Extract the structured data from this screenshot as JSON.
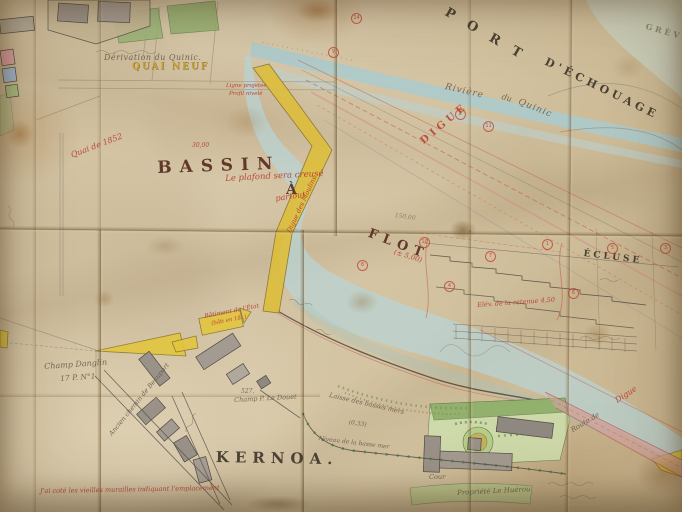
{
  "colors": {
    "paper": "#d3c3a2",
    "paper_shadow": "#b89f78",
    "water_blue": "#b7d6da",
    "water_pale": "#c9dcd4",
    "quay_yellow": "#ddbe3e",
    "garden_green": "#9ab578",
    "building_gray": "#9a9288",
    "road_pink": "#d2a2a0",
    "ink_dark": "#3f382f",
    "ink_maroon": "#5c2f24",
    "ink_red": "#b6372a",
    "pencil": "#8d8273"
  },
  "labels": [
    {
      "id": "port",
      "text": "PORT",
      "x": 449,
      "y": 6,
      "rot": 30,
      "fs": 13,
      "ls": 15,
      "cls": "ink-caps"
    },
    {
      "id": "d-echouage",
      "text": "D'ÉCHOUAGE",
      "x": 548,
      "y": 56,
      "rot": 26,
      "fs": 11,
      "ls": 4,
      "cls": "ink-caps"
    },
    {
      "id": "greve",
      "text": "GRÈVE",
      "x": 647,
      "y": 22,
      "rot": 16,
      "fs": 8,
      "ls": 3,
      "cls": "ink-caps faint"
    },
    {
      "id": "bassin",
      "text": "BASSIN",
      "x": 157,
      "y": 160,
      "rot": -2,
      "fs": 17,
      "ls": 8,
      "cls": "maroon"
    },
    {
      "id": "bassin-a",
      "text": "À",
      "x": 286,
      "y": 183,
      "rot": 0,
      "fs": 14,
      "ls": 0,
      "cls": "maroon"
    },
    {
      "id": "flot",
      "text": "FLOT",
      "x": 371,
      "y": 227,
      "rot": 21,
      "fs": 13,
      "ls": 6,
      "cls": "maroon"
    },
    {
      "id": "kernoa",
      "text": "KERNOA.",
      "x": 216,
      "y": 450,
      "rot": 1,
      "fs": 15,
      "ls": 6,
      "cls": "ink-caps"
    },
    {
      "id": "ecluse",
      "text": "ÉCLUSE",
      "x": 584,
      "y": 250,
      "rot": 7,
      "fs": 9,
      "ls": 3,
      "cls": "ink-caps"
    },
    {
      "id": "quai-neuf",
      "text": "QUAI NEUF",
      "x": 132,
      "y": 63,
      "rot": 0,
      "fs": 9,
      "ls": 2,
      "cls": "yellowb"
    },
    {
      "id": "derivation",
      "text": "Dérivation du Quinic.",
      "x": 104,
      "y": 54,
      "rot": 0,
      "fs": 8,
      "ls": 0.5,
      "cls": "cursive"
    },
    {
      "id": "riviere",
      "text": "Rivière",
      "x": 446,
      "y": 83,
      "rot": 13,
      "fs": 9,
      "ls": 1,
      "cls": "cursive"
    },
    {
      "id": "riviere-du",
      "text": "du",
      "x": 503,
      "y": 93,
      "rot": 18,
      "fs": 8,
      "ls": 0,
      "cls": "cursive"
    },
    {
      "id": "riviere-quinic",
      "text": "Quinic",
      "x": 520,
      "y": 98,
      "rot": 22,
      "fs": 9,
      "ls": 1,
      "cls": "cursive"
    },
    {
      "id": "quai-1852",
      "text": "Quai de 1852",
      "x": 70,
      "y": 152,
      "rot": -21,
      "fs": 8,
      "ls": 0,
      "cls": "redc"
    },
    {
      "id": "ligne-projetee",
      "text": "Ligne projetée",
      "x": 226,
      "y": 84,
      "rot": 0,
      "fs": 5.5,
      "ls": 0,
      "cls": "redc"
    },
    {
      "id": "profil-nivele",
      "text": "Profil nivelé",
      "x": 229,
      "y": 92,
      "rot": 0,
      "fs": 5.5,
      "ls": 0,
      "cls": "redc"
    },
    {
      "id": "plafond-note",
      "text": "Le plafond sera creusé",
      "x": 225,
      "y": 175,
      "rot": -3,
      "fs": 8.5,
      "ls": 0,
      "cls": "redc"
    },
    {
      "id": "partout",
      "text": "partout",
      "x": 275,
      "y": 195,
      "rot": -8,
      "fs": 8,
      "ls": 0,
      "cls": "redc"
    },
    {
      "id": "digue-des-moulins",
      "text": "Digue des Moulins",
      "x": 286,
      "y": 231,
      "rot": -65,
      "fs": 6.5,
      "ls": 0,
      "cls": "redc"
    },
    {
      "id": "digue",
      "text": "DIGUE",
      "x": 419,
      "y": 139,
      "rot": -40,
      "fs": 10,
      "ls": 4,
      "cls": "redcaps"
    },
    {
      "id": "cote-5",
      "text": "(± 5,00)",
      "x": 395,
      "y": 249,
      "rot": 17,
      "fs": 7,
      "ls": 0,
      "cls": "redc"
    },
    {
      "id": "cote-30",
      "text": "30,00",
      "x": 192,
      "y": 143,
      "rot": 0,
      "fs": 6,
      "ls": 0,
      "cls": "redc"
    },
    {
      "id": "cote-150",
      "text": "150,00",
      "x": 395,
      "y": 213,
      "rot": 8,
      "fs": 6,
      "ls": 0,
      "cls": "pencil"
    },
    {
      "id": "retenue",
      "text": "Elév. de la retenue 4,50",
      "x": 477,
      "y": 302,
      "rot": -4,
      "fs": 6.5,
      "ls": 0,
      "cls": "redc"
    },
    {
      "id": "batiment-etat",
      "text": "Bâtiment de l'État",
      "x": 204,
      "y": 314,
      "rot": -11,
      "fs": 6,
      "ls": 0,
      "cls": "redc"
    },
    {
      "id": "batiment-etat-2",
      "text": "(bâti en 18..)",
      "x": 211,
      "y": 322,
      "rot": -11,
      "fs": 5.5,
      "ls": 0,
      "cls": "redc"
    },
    {
      "id": "note-murailles",
      "text": "J'ai coté les vieilles murailles indiquant l'emplacement",
      "x": 40,
      "y": 488,
      "rot": -1,
      "fs": 6.5,
      "ls": 0,
      "cls": "redc"
    },
    {
      "id": "digue-route",
      "text": "Digue",
      "x": 614,
      "y": 398,
      "rot": -33,
      "fs": 8,
      "ls": 0,
      "cls": "redc"
    },
    {
      "id": "champ-danglin",
      "text": "Champ Danglin",
      "x": 44,
      "y": 363,
      "rot": -4,
      "fs": 8,
      "ls": 0,
      "cls": "cursive"
    },
    {
      "id": "champ-danglin-2",
      "text": "17 P. N°1.",
      "x": 60,
      "y": 375,
      "rot": -4,
      "fs": 7.5,
      "ls": 0,
      "cls": "cursive"
    },
    {
      "id": "ancien-chemin",
      "text": "Ancien chemin de Beauport",
      "x": 108,
      "y": 433,
      "rot": -51,
      "fs": 6.5,
      "ls": 0,
      "cls": "cursive"
    },
    {
      "id": "parcel-527",
      "text": "527.",
      "x": 241,
      "y": 389,
      "rot": 0,
      "fs": 6,
      "ls": 0,
      "cls": "cursive"
    },
    {
      "id": "champ-le-douet",
      "text": "Champ P. Le Douet",
      "x": 234,
      "y": 397,
      "rot": -3,
      "fs": 6.5,
      "ls": 0,
      "cls": "cursive"
    },
    {
      "id": "cour",
      "text": "Cour",
      "x": 429,
      "y": 474,
      "rot": 0,
      "fs": 6.5,
      "ls": 0,
      "cls": "cursive"
    },
    {
      "id": "propriete-le-huerou",
      "text": "Propriété Le Huérou",
      "x": 457,
      "y": 490,
      "rot": -3,
      "fs": 7,
      "ls": 0,
      "cls": "cursive"
    },
    {
      "id": "laisse-basses-mers",
      "text": "Laisse des basses mers",
      "x": 330,
      "y": 392,
      "rot": 13,
      "fs": 6.5,
      "ls": 0,
      "cls": "cursive"
    },
    {
      "id": "cote-033",
      "text": "(0,33)",
      "x": 349,
      "y": 420,
      "rot": 8,
      "fs": 6,
      "ls": 0,
      "cls": "cursive"
    },
    {
      "id": "niveau-basse-mer",
      "text": "Niveau de la basse mer",
      "x": 319,
      "y": 436,
      "rot": 7,
      "fs": 6,
      "ls": 0,
      "cls": "cursive"
    },
    {
      "id": "route-de",
      "text": "Route de",
      "x": 570,
      "y": 428,
      "rot": -31,
      "fs": 7,
      "ls": 0,
      "cls": "cursive"
    }
  ],
  "circled_numbers": [
    {
      "n": "14",
      "x": 351,
      "y": 13
    },
    {
      "n": "9",
      "x": 328,
      "y": 47
    },
    {
      "n": "2",
      "x": 455,
      "y": 109
    },
    {
      "n": "11",
      "x": 483,
      "y": 121
    },
    {
      "n": "10",
      "x": 419,
      "y": 237
    },
    {
      "n": "1",
      "x": 542,
      "y": 239
    },
    {
      "n": "5",
      "x": 607,
      "y": 243
    },
    {
      "n": "3",
      "x": 660,
      "y": 243
    },
    {
      "n": "7",
      "x": 485,
      "y": 251
    },
    {
      "n": "6",
      "x": 568,
      "y": 288
    },
    {
      "n": "8",
      "x": 357,
      "y": 260
    },
    {
      "n": "4",
      "x": 444,
      "y": 281
    }
  ]
}
